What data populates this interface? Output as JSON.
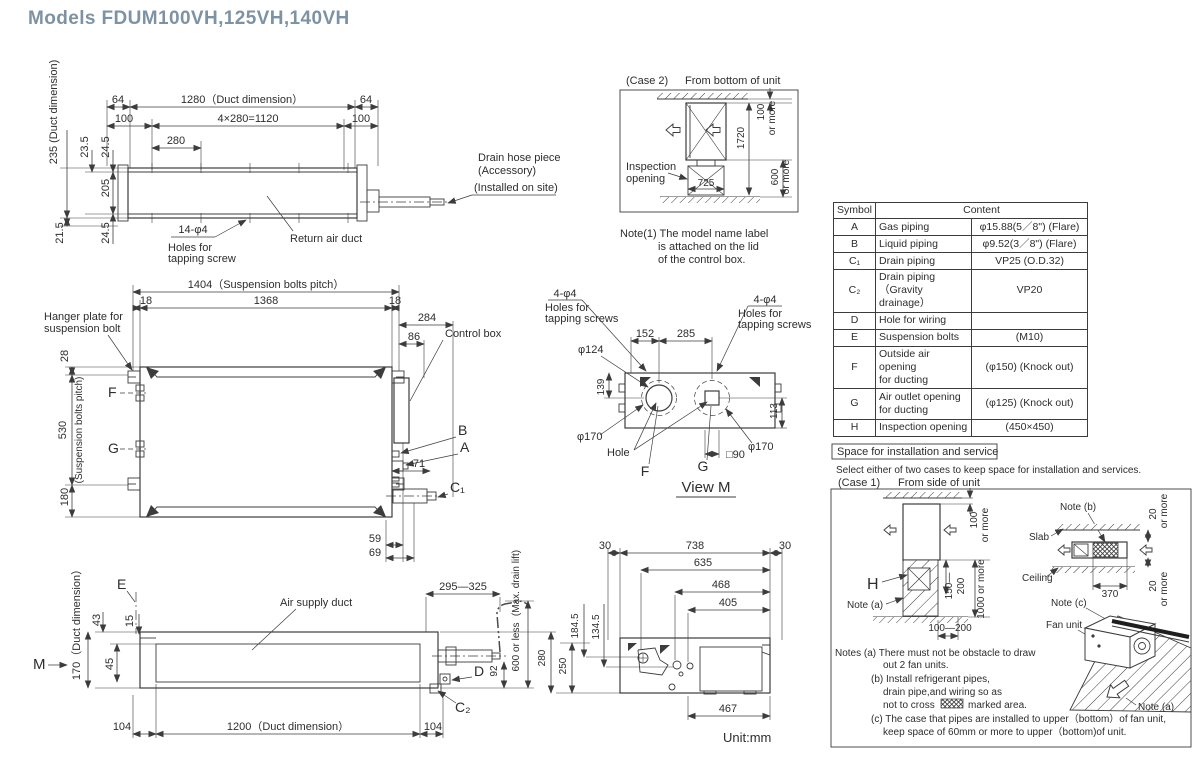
{
  "title": "Models  FDUM100VH,125VH,140VH",
  "unit_note": "Unit:mm",
  "top_view": {
    "d64_left": "64",
    "d1280": "1280（Duct dimension）",
    "d64_right": "64",
    "d100_left": "100",
    "d1120": "4×280=1120",
    "d100_right": "100",
    "d280": "280",
    "d235": "235 (Duct dimension)",
    "d23_5": "23.5",
    "d24_5_top": "24.5",
    "d205": "205",
    "d21_5": "21.5",
    "d24_5_bot": "24.5",
    "holes_dim": "14-φ4",
    "holes_line1": "Holes for",
    "holes_line2": "tapping screw",
    "return_air_duct": "Return air duct",
    "drain_line1": "Drain hose piece",
    "drain_line2": "(Accessory)",
    "drain_line3": "(Installed on site)"
  },
  "case2": {
    "label": "(Case 2)",
    "caption": "From bottom of unit",
    "inspection_line1": "Inspection",
    "inspection_line2": "opening",
    "d100": "100",
    "d100_more": "or more",
    "d1720": "1720",
    "d600": "600",
    "d600_more": "or more",
    "d725": "725",
    "note_line1": "Note(1)  The model name label",
    "note_line2": "is attached on the lid",
    "note_line3": "of the control box."
  },
  "symbol_table": {
    "header_symbol": "Symbol",
    "header_content": "Content",
    "rows": [
      {
        "sym": "A",
        "item": "Gas piping",
        "value": "φ15.88(5／8\") (Flare)"
      },
      {
        "sym": "B",
        "item": "Liquid piping",
        "value": "φ9.52(3／8\") (Flare)"
      },
      {
        "sym": "C₁",
        "item": "Drain piping",
        "value": "VP25 (O.D.32)"
      },
      {
        "sym": "C₂",
        "item": "Drain piping",
        "item2": "（Gravity drainage）",
        "value": "VP20"
      },
      {
        "sym": "D",
        "item": "Hole for wiring",
        "value": ""
      },
      {
        "sym": "E",
        "item": "Suspension bolts",
        "value": "(M10)"
      },
      {
        "sym": "F",
        "item": "Outside air opening",
        "item2": "for ducting",
        "value": "(φ150) (Knock out)"
      },
      {
        "sym": "G",
        "item": "Air outlet opening",
        "item2": "for ducting",
        "value": "(φ125) (Knock out)"
      },
      {
        "sym": "H",
        "item": "Inspection opening",
        "value": "(450×450)"
      }
    ]
  },
  "plan_view": {
    "d1404": "1404（Suspension bolts pitch）",
    "d18_left": "18",
    "d1368": "1368",
    "d18_right": "18",
    "d284": "284",
    "d86": "86",
    "hanger_line1": "Hanger plate for",
    "hanger_line2": "suspension bolt",
    "d28": "28",
    "d530": "530",
    "d530_note": "(Suspension bolts pitch)",
    "d180": "180",
    "f_label": "F",
    "g_label": "G",
    "control_box": "Control box",
    "b_label": "B",
    "a_label": "A",
    "d71": "71",
    "c1_label": "C₁",
    "d59": "59",
    "d69": "69"
  },
  "view_m": {
    "holes_left_dim": "4-φ4",
    "holes_left_line1": "Holes for",
    "holes_left_line2": "tapping screws",
    "holes_right_dim": "4-φ4",
    "holes_right_line1": "Holes for",
    "holes_right_line2": "tapping screws",
    "d152": "152",
    "d285": "285",
    "d124": "φ124",
    "d139": "139",
    "d170_left": "φ170",
    "d170_right": "φ170",
    "d113": "113",
    "hole": "Hole",
    "d90": "□90",
    "f_label": "F",
    "g_label": "G",
    "title": "View M"
  },
  "bottom_view": {
    "e_label": "E",
    "m_label": "M",
    "d170": "170（Duct dimension）",
    "d43": "43",
    "d15": "15",
    "d45": "45",
    "air_supply_duct": "Air supply duct",
    "d295_325": "295—325",
    "max_drain_lift": "(Max. drain lift)",
    "d600_or_less": "600 or less",
    "d92": "92",
    "d280": "280",
    "d250": "250",
    "d_label": "D",
    "c2_label": "C₂",
    "d104_left": "104",
    "d1200": "1200（Duct dimension）",
    "d104_right": "104"
  },
  "side_view": {
    "d30_left": "30",
    "d738": "738",
    "d30_right": "30",
    "d635": "635",
    "d468": "468",
    "d405": "405",
    "d184_5": "184.5",
    "d134_5": "134.5",
    "d467": "467"
  },
  "install": {
    "box_title": "Space for installation and service",
    "intro": "Select either of two cases to keep space for installation and services.",
    "case1_label": "(Case 1)",
    "case1_caption": "From side of unit",
    "d100": "100",
    "d100_more": "or more",
    "h_label": "H",
    "note_a": "Note (a)",
    "d150_line1": "150—",
    "d150_line2": "200",
    "d1000": "1000 or more",
    "d100_200": "100—200",
    "note_b": "Note (b)",
    "slab": "Slab",
    "ceiling": "Ceiling",
    "d370": "370",
    "d20_top": "20",
    "d20_top_more": "or more",
    "d20_bot": "20",
    "d20_bot_more": "or more",
    "note_c": "Note (c)",
    "fan_unit": "Fan unit",
    "note_a2": "Note (a)",
    "notes_a1": "Notes (a)  There must not be obstacle to draw",
    "notes_a2": "out 2 fan units.",
    "notes_b1": "(b)  Install refrigerant pipes,",
    "notes_b2": "drain pipe,and wiring so as",
    "notes_b3_pre": "not to cross",
    "notes_b3_post": "marked area.",
    "notes_c1": "(c)  The case that pipes are installed to upper（bottom）of fan unit,",
    "notes_c2": "keep space of 60mm or more to upper（bottom)of unit."
  }
}
